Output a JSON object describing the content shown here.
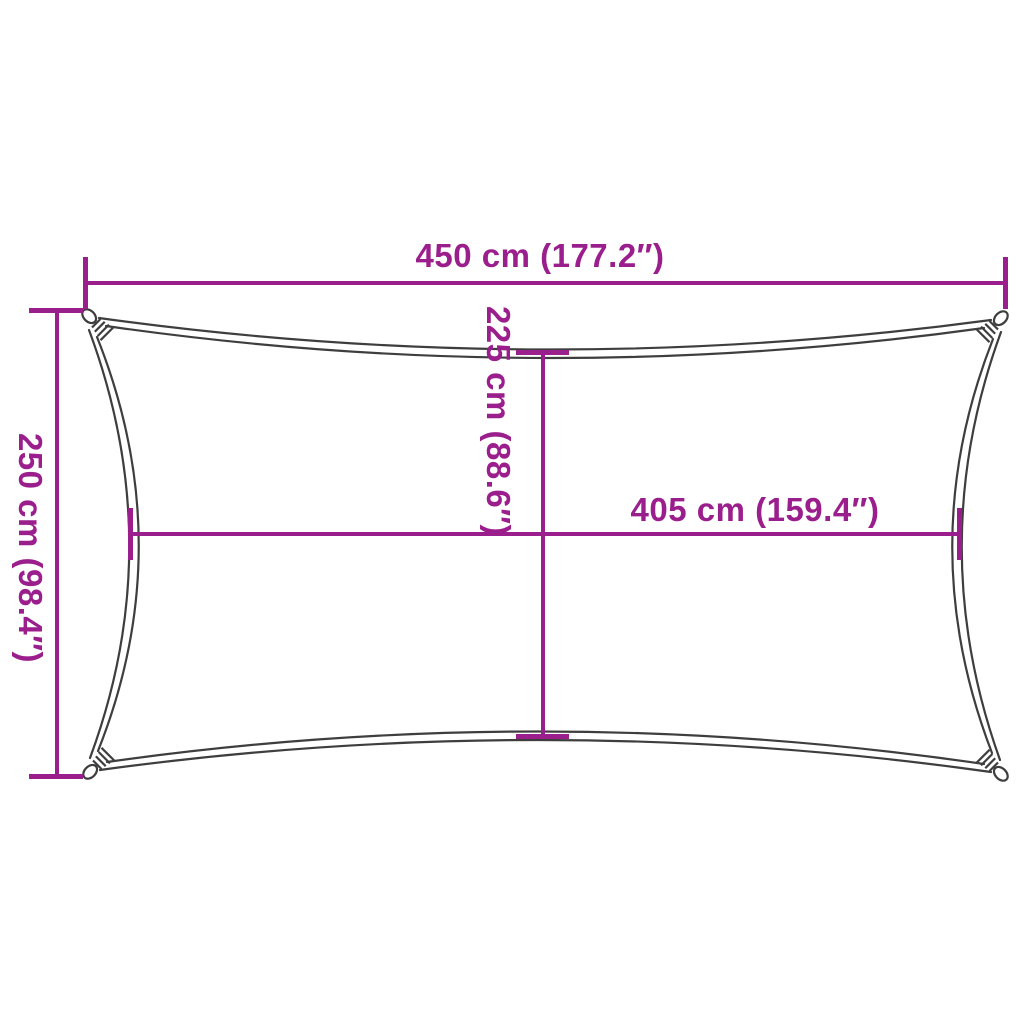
{
  "colors": {
    "accent": "#9B1E8D",
    "outline": "#3E3E3E",
    "background": "#FFFFFF"
  },
  "diagram": {
    "kind": "shade-sail-dimension-diagram",
    "dimensions": {
      "top_width": {
        "label": "450 cm (177.2″)",
        "cm": 450,
        "inches": 177.2
      },
      "left_height": {
        "label": "250 cm (98.4″)",
        "cm": 250,
        "inches": 98.4
      },
      "center_height": {
        "label": "225 cm (88.6″)",
        "cm": 225,
        "inches": 88.6
      },
      "center_width": {
        "label": "405 cm (159.4″)",
        "cm": 405,
        "inches": 159.4
      }
    }
  }
}
